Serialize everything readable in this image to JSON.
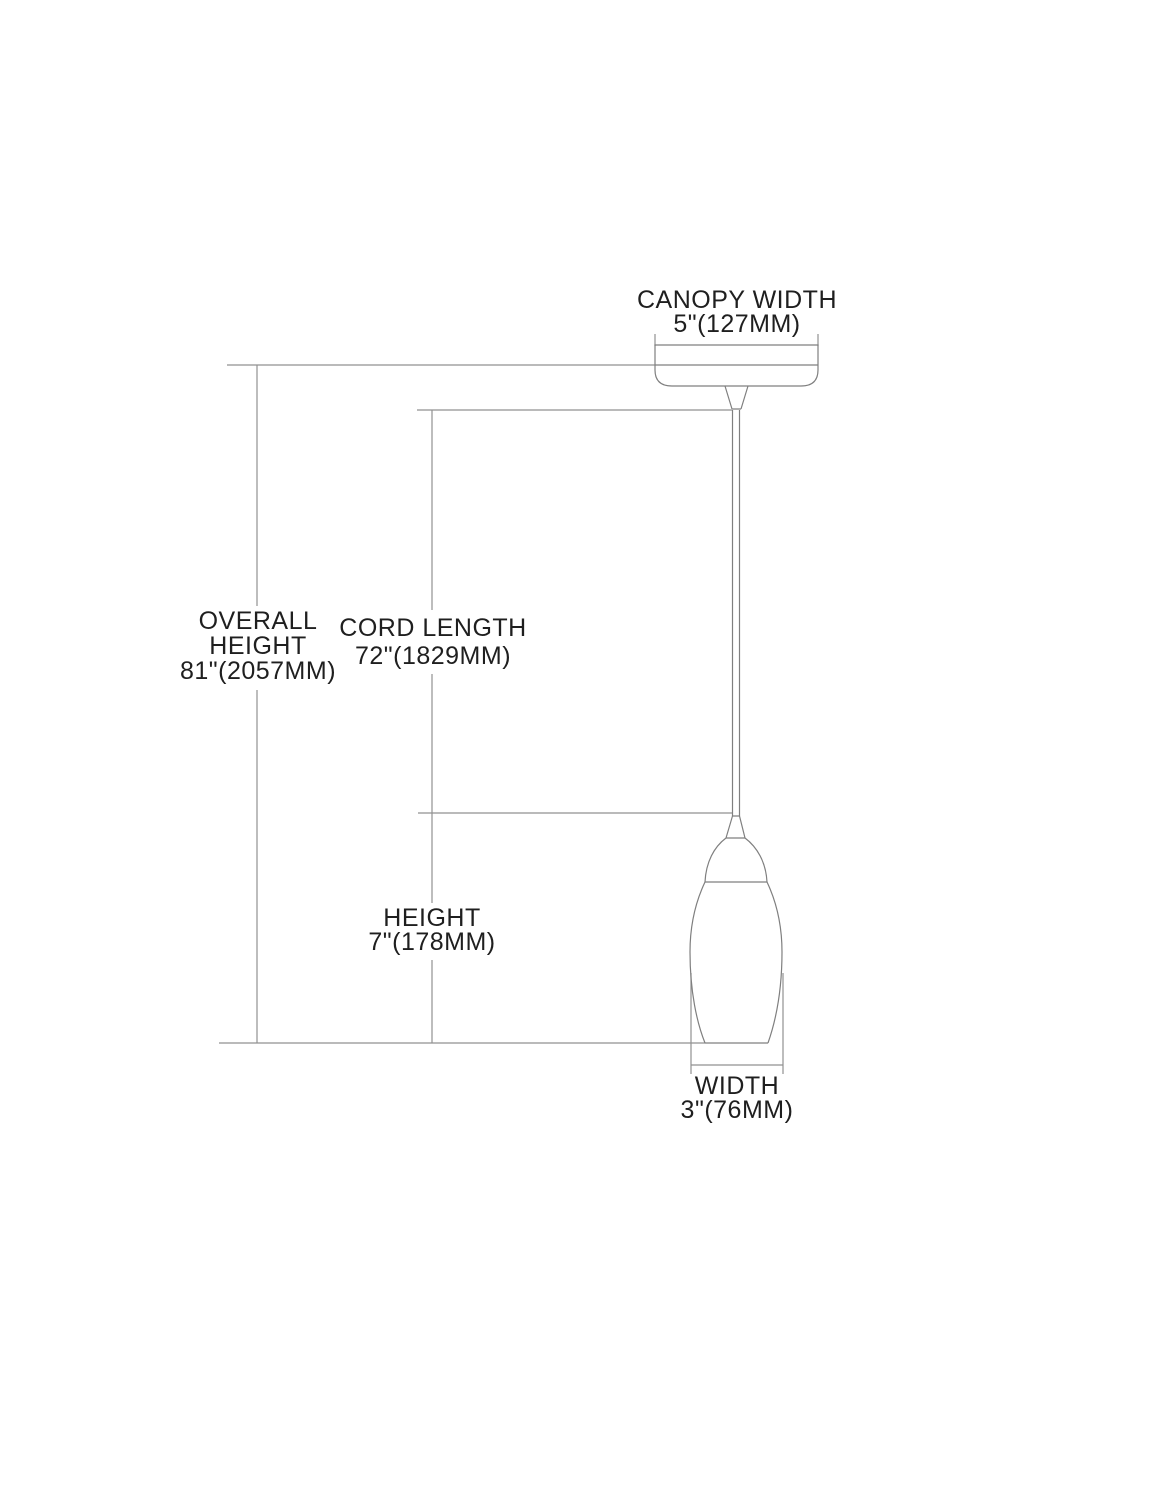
{
  "drawing": {
    "kind": "pendant-light-dimension-diagram",
    "labels": {
      "canopy_width": {
        "title": "CANOPY WIDTH",
        "value": "5\"(127MM)"
      },
      "overall_height": {
        "title_line1": "OVERALL",
        "title_line2": "HEIGHT",
        "value": "81\"(2057MM)"
      },
      "cord_length": {
        "title": "CORD LENGTH",
        "value": "72\"(1829MM)"
      },
      "height": {
        "title": "HEIGHT",
        "value": "7\"(178MM)"
      },
      "width": {
        "title": "WIDTH",
        "value": "3\"(76MM)"
      }
    },
    "colors": {
      "background": "#ffffff",
      "dimension_line": "#919191",
      "fixture_line": "#7f7f7f",
      "text": "#1f1f1f"
    }
  }
}
